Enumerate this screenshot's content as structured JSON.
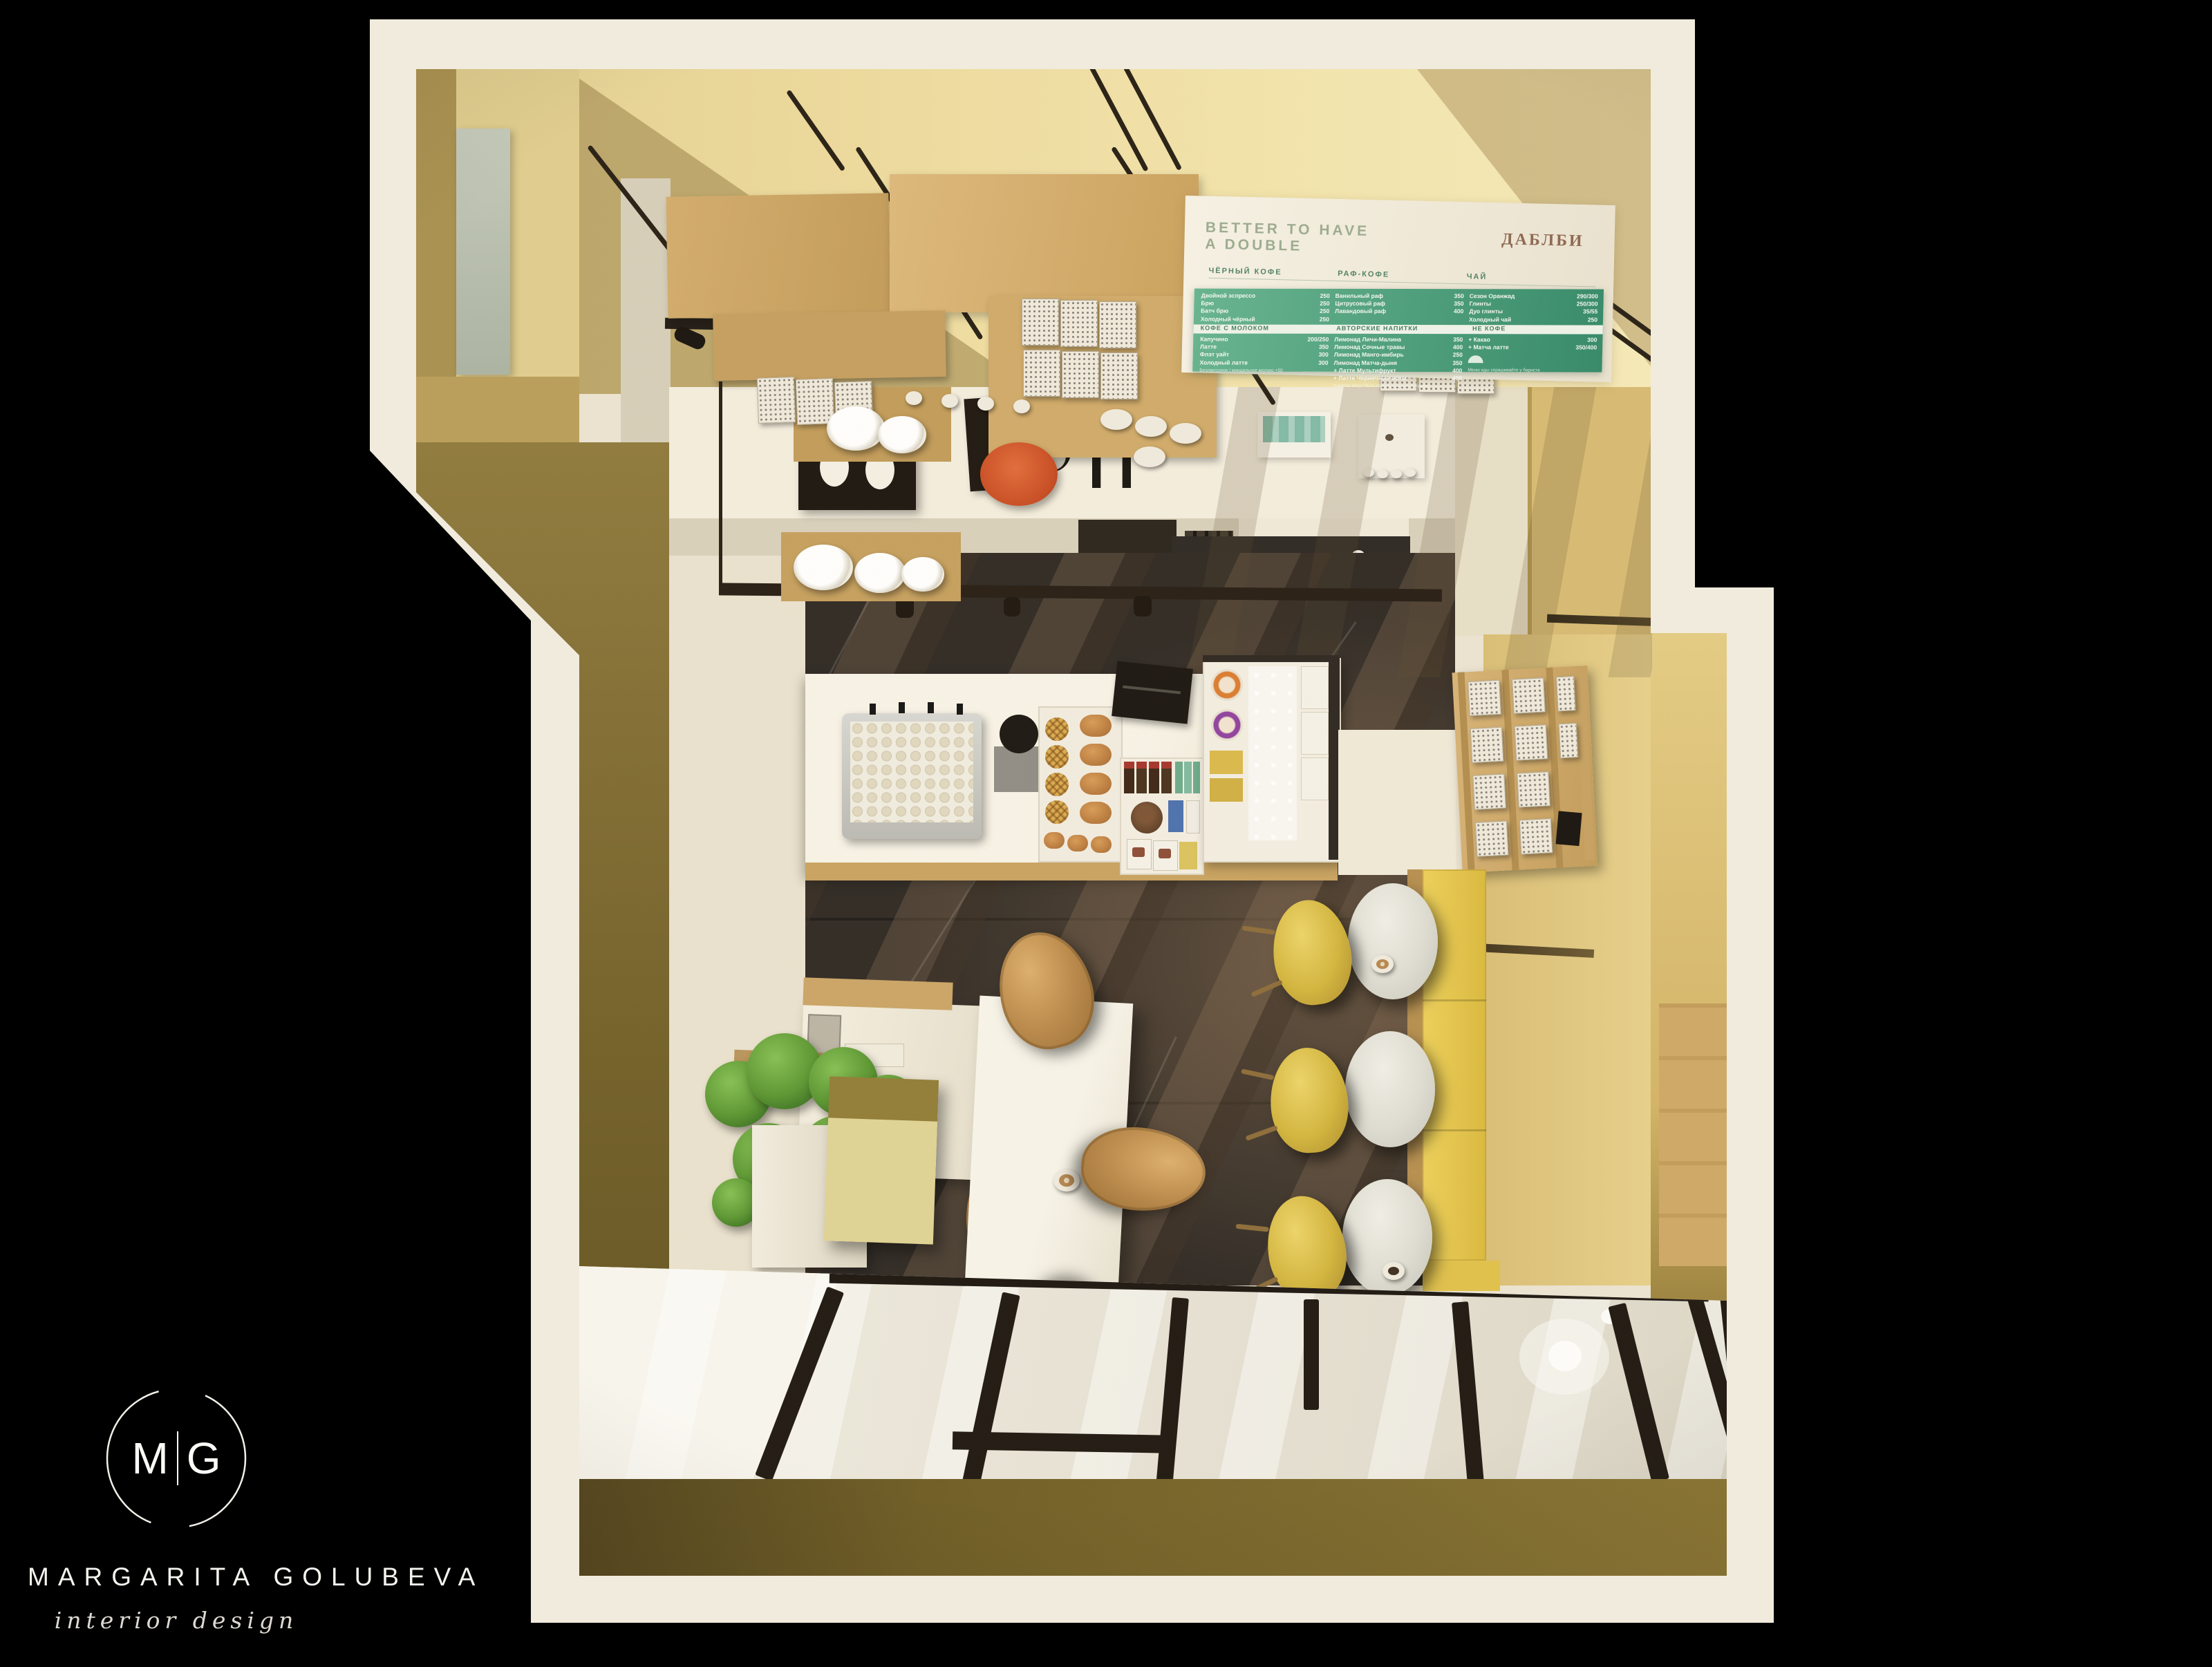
{
  "branding": {
    "monogram_left": "M",
    "monogram_right": "G",
    "designer_name": "MARGARITA GOLUBEVA",
    "tagline": "interior design"
  },
  "menu_board": {
    "headline_line1": "BETTER TO HAVE",
    "headline_line2": "A DOUBLE",
    "brand": "ДАБЛБИ",
    "sections": [
      {
        "name": "ЧЁРНЫЙ КОФЕ",
        "footnote": "горячий / холодный",
        "items": [
          {
            "label": "Двойной эспрессо",
            "price": "250"
          },
          {
            "label": "Брю",
            "price": "250"
          },
          {
            "label": "Батч брю",
            "price": "250"
          },
          {
            "label": "Холодный чёрный",
            "price": "250"
          },
          {
            "label": "Ручные методы заваривания",
            "price": "300"
          }
        ]
      },
      {
        "name": "РАФ-КОФЕ",
        "footnote": "",
        "items": [
          {
            "label": "Ванильный раф",
            "price": "350"
          },
          {
            "label": "Цитрусовый раф",
            "price": "350"
          },
          {
            "label": "Лавандовый раф",
            "price": "400"
          }
        ]
      },
      {
        "name": "ЧАЙ",
        "footnote": "все чаи подаются с десертом",
        "items": [
          {
            "label": "Сезон Оранжад",
            "price": "290/300"
          },
          {
            "label": "Глинты",
            "price": "250/300"
          },
          {
            "label": "Дуо глинты",
            "price": "35/55"
          },
          {
            "label": "Холодный чай",
            "price": "250"
          }
        ]
      },
      {
        "name": "КОФЕ С МОЛОКОМ",
        "footnote": "Безлактозное / миндальное молоко +50",
        "items": [
          {
            "label": "Капучино",
            "price": "200/250"
          },
          {
            "label": "Латте",
            "price": "350"
          },
          {
            "label": "Флэт уайт",
            "price": "300"
          },
          {
            "label": "Холодный латте",
            "price": "300"
          }
        ]
      },
      {
        "name": "АВТОРСКИЕ НАПИТКИ",
        "footnote": "Напитки могут быть приготовлены холодными",
        "items": [
          {
            "label": "Лимонад Личи-Малина",
            "price": "350"
          },
          {
            "label": "Лимонад Сочные травы",
            "price": "400"
          },
          {
            "label": "Лимонад Манго-имбирь",
            "price": "250"
          },
          {
            "label": "Лимонад Матча-дыня",
            "price": "350"
          },
          {
            "label": "+ Латте Мультифрукт",
            "price": "400"
          },
          {
            "label": "+ Латте Черничные ноты",
            "price": "400"
          }
        ]
      },
      {
        "name": "НЕ КОФЕ",
        "footnote": "Меню еды спрашивайте у бариста",
        "items": [
          {
            "label": "+ Какао",
            "price": "300"
          },
          {
            "label": "+ Матча латте",
            "price": "350/400"
          }
        ]
      }
    ]
  },
  "palette": {
    "background": "#000000",
    "wall_cut_cream": "#f0ebdc",
    "wall_yellow": "#ecd89b",
    "wall_mustard": "#d6ba72",
    "wall_olive": "#6f5d26",
    "floor_light": "#ebe4d2",
    "floor_marble": "#2b2622",
    "wood": "#c9a568",
    "menu_green": "#3f9e78",
    "accent_orange": "#d4502a",
    "banquette_yellow": "#e7c64b",
    "chair_tan": "#bb8a4b",
    "chair_mustard": "#d2b43c",
    "logo_white": "#fcfbf7"
  }
}
